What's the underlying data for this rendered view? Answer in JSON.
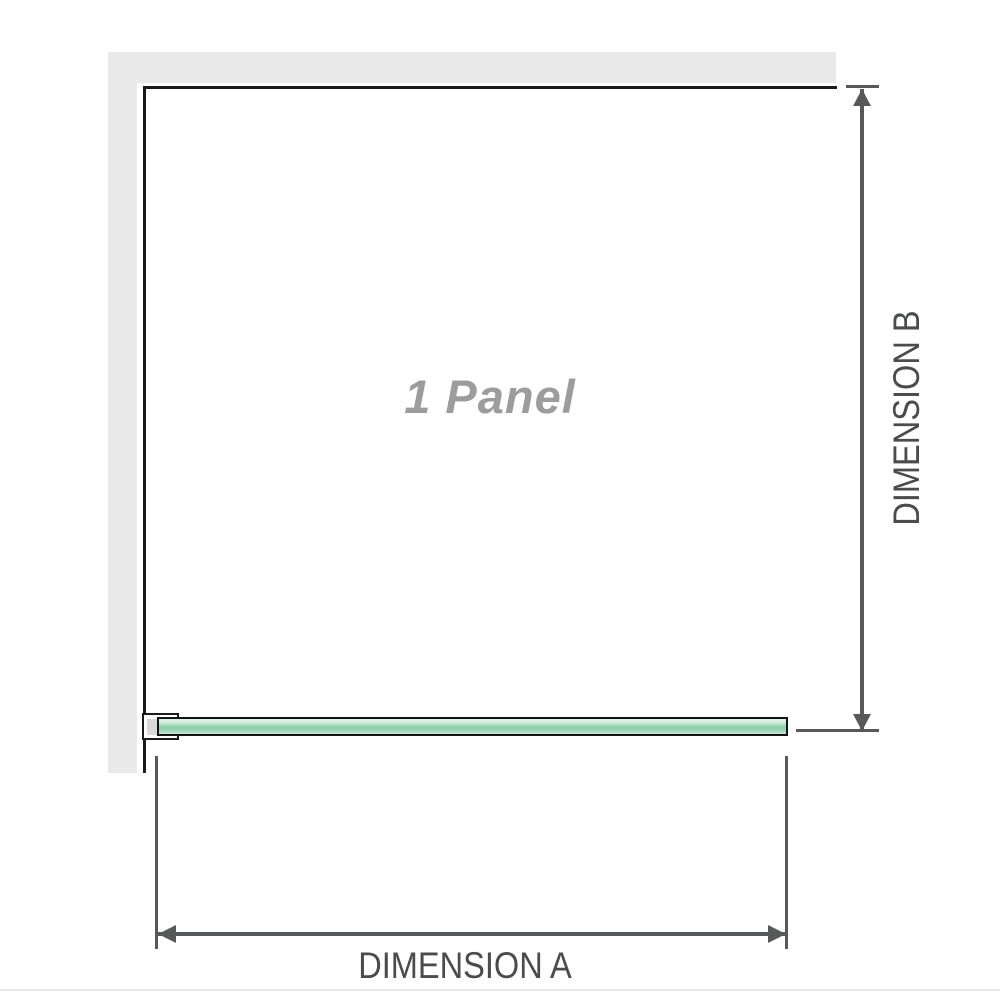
{
  "diagram": {
    "panel_label": "1 Panel",
    "dimension_a_label": "DIMENSION A",
    "dimension_b_label": "DIMENSION B"
  },
  "colors": {
    "wall": "#e9e9e9",
    "panel-border": "#1a1a1a",
    "dim": "#57585a",
    "label": "#4a4b4d",
    "panel-label": "#9c9c9c",
    "glass-light": "#d9f0e2",
    "glass-mid": "#92cfac",
    "glass-soft": "#c6e7d2",
    "glass-outline": "#141414",
    "bracket-fill": "#ffffff",
    "bracket-inner": "#d9d9d9",
    "rule": "#e9e9e9"
  }
}
